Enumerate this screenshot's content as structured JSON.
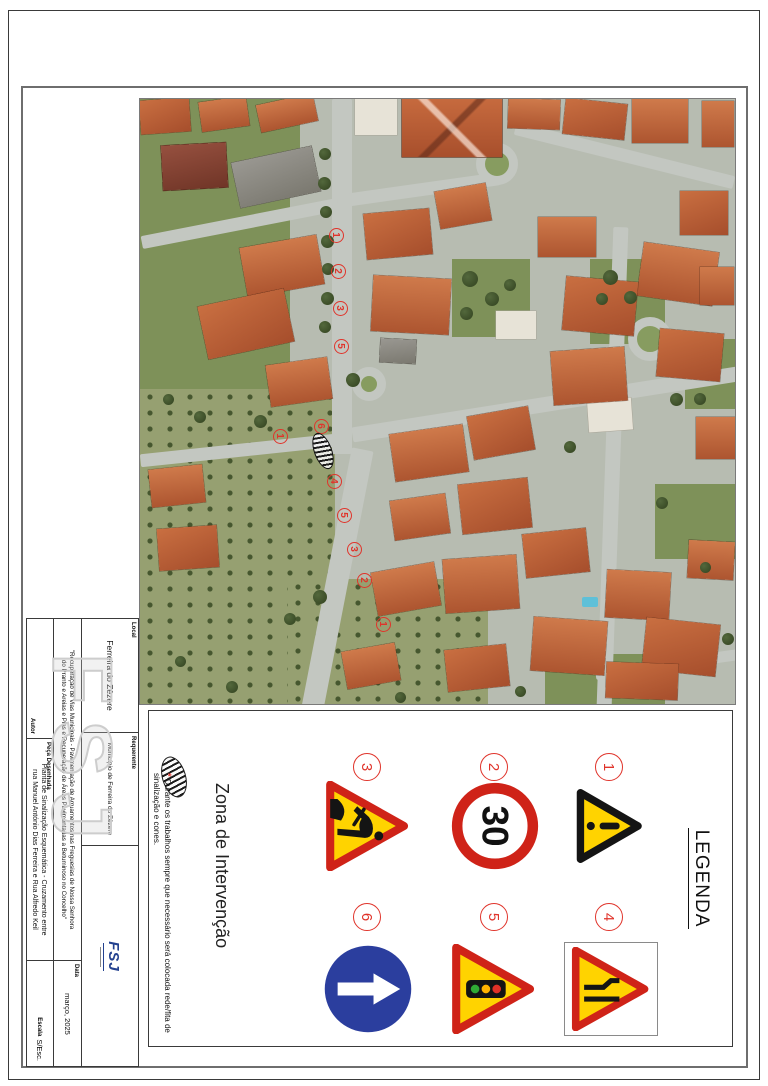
{
  "title_block": {
    "local_label": "Local",
    "local_value": "Ferreira do Zêzere",
    "requerente_label": "Requerente",
    "requerente_value": "Município de Ferreira do Zêzere",
    "autor_label": "Autor",
    "peca_label": "Peça Desenhada",
    "peca_value_line1": "Planta de Sinalização Esquemática - Cruzamento entre",
    "peca_value_line2": "rua Manuel António Dias Ferreira e Rua Alfredo Keil",
    "data_label": "Data",
    "data_value": "março, 2025",
    "escala_label": "Escala",
    "escala_value": "S/Esc.",
    "description_line1": "\"Recuperação de Vias Municipais - Pavimentação de Arruamentos nas Freguesias de Nossa Senhora",
    "description_line2": "do Pranto e Areias e Pias e Recuperação de Áreas Pavimentadas a Betuminoso no Concelho\"",
    "logo_text": "FSJ",
    "watermark_text": "FSJ"
  },
  "legend": {
    "title": "LEGENDA",
    "zona_label": "Zona de Intervenção",
    "note_asterisk": "*",
    "note_line1": "Durante os trabalhos sempre que necessário será colocada rede/fita de",
    "note_line2": "sinalização e cones.",
    "signs": [
      {
        "number": "1",
        "glyph": "danger"
      },
      {
        "number": "2",
        "glyph": "speed",
        "text": "30"
      },
      {
        "number": "3",
        "glyph": "works"
      },
      {
        "number": "4",
        "glyph": "narrow"
      },
      {
        "number": "5",
        "glyph": "lights"
      },
      {
        "number": "6",
        "glyph": "ahead"
      }
    ],
    "colors": {
      "number_red": "#e0342b",
      "sign_red": "#cf2318",
      "sign_yellow": "#ffd300",
      "sign_blue": "#2b3e9e"
    }
  },
  "map": {
    "markers": [
      {
        "label": "1",
        "x": 136,
        "y": 398
      },
      {
        "label": "2",
        "x": 172,
        "y": 396
      },
      {
        "label": "3",
        "x": 209,
        "y": 394
      },
      {
        "label": "5",
        "x": 247,
        "y": 393
      },
      {
        "label": "6",
        "x": 327,
        "y": 413
      },
      {
        "label": "1",
        "x": 337,
        "y": 454
      },
      {
        "label": "4",
        "x": 382,
        "y": 400
      },
      {
        "label": "5",
        "x": 416,
        "y": 390
      },
      {
        "label": "3",
        "x": 450,
        "y": 380
      },
      {
        "label": "2",
        "x": 481,
        "y": 370
      },
      {
        "label": "1",
        "x": 525,
        "y": 351
      }
    ],
    "zone": {
      "x": 351,
      "y": 411
    }
  }
}
